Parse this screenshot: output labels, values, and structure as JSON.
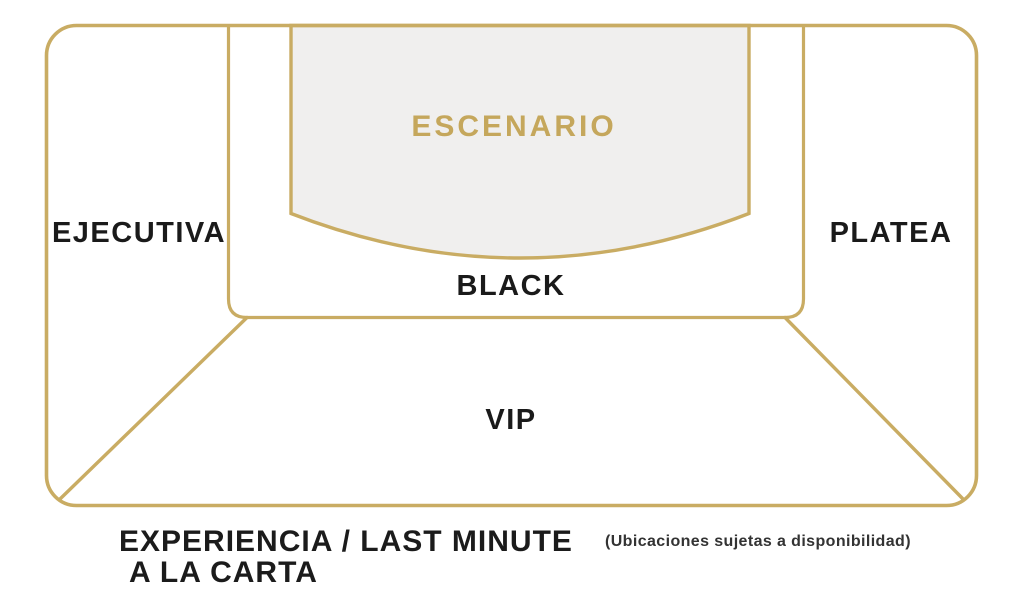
{
  "map": {
    "stage_label": "ESCENARIO",
    "sections": {
      "ejecutiva": "EJECUTIVA",
      "black": "BLACK",
      "platea": "PLATEA",
      "vip": "VIP"
    }
  },
  "footer": {
    "heading_line1": "EXPERIENCIA / LAST MINUTE",
    "heading_line2": "A LA CARTA",
    "availability_note": "(Ubicaciones sujetas a disponibilidad)"
  },
  "colors": {
    "gold_outline": "#C9AC63",
    "stage_text_gold": "#C5A75C",
    "stage_fill": "#F0EFEE",
    "label_text": "#1A1A1A"
  }
}
